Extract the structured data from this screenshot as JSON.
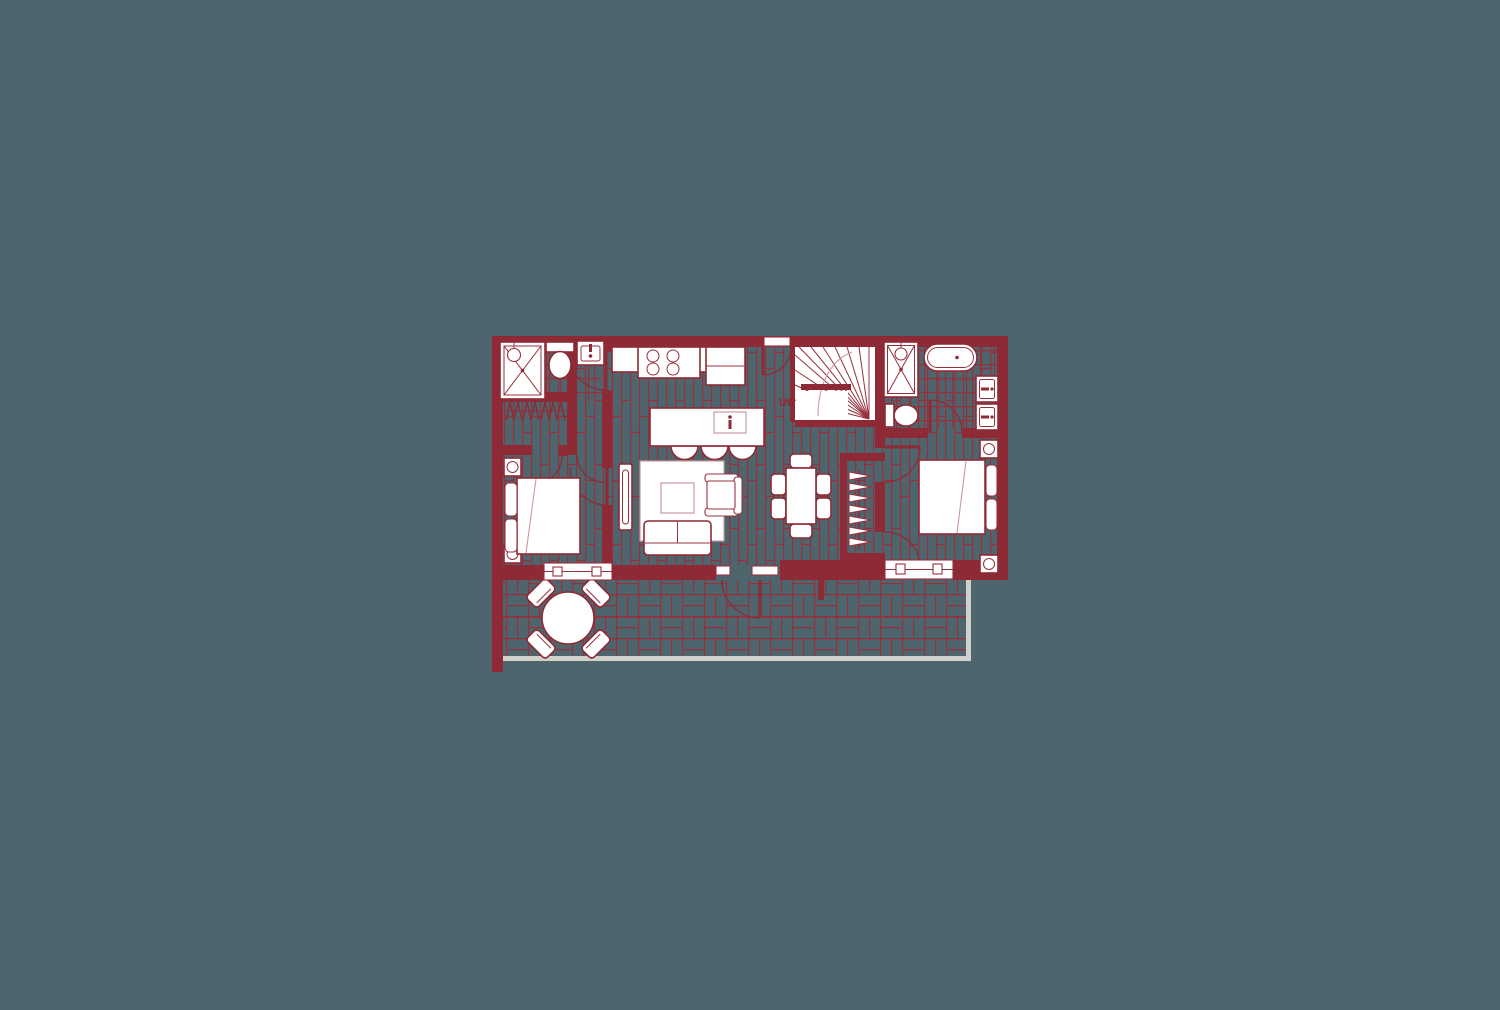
{
  "stairs": {
    "up_label": "UP"
  },
  "colors": {
    "background": "#4E656D",
    "wall_red": "#8E2A35",
    "line_red": "#96303C",
    "soft_red": "#C99BA1",
    "fixture_white": "#FFFFFF",
    "railing_gray": "#D0D1CB"
  },
  "plan": {
    "type": "apartment-floor-plan",
    "fixtures": [
      "shower",
      "toilet",
      "wall-sink",
      "closet-hangers",
      "kitchen-counter",
      "cooktop-4-burner",
      "kitchen-island-with-sink",
      "bar-stools-x3",
      "winder-staircase",
      "handrail",
      "entry-door",
      "ensuite-shower",
      "freestanding-tub",
      "double-vanity",
      "ensuite-toilet",
      "double-bed-x2",
      "nightstand-lamp-x4",
      "tv-console",
      "area-rug",
      "coffee-table",
      "armchair",
      "loveseat-sofa",
      "dining-table",
      "dining-chairs-x6",
      "wardrobe-hangers-column",
      "sliding-window-x2",
      "balcony-round-table",
      "balcony-chairs-x4",
      "balcony-railing"
    ],
    "floor_finishes": [
      "wood-plank",
      "bathroom-tile-grid",
      "balcony-basketweave"
    ]
  }
}
